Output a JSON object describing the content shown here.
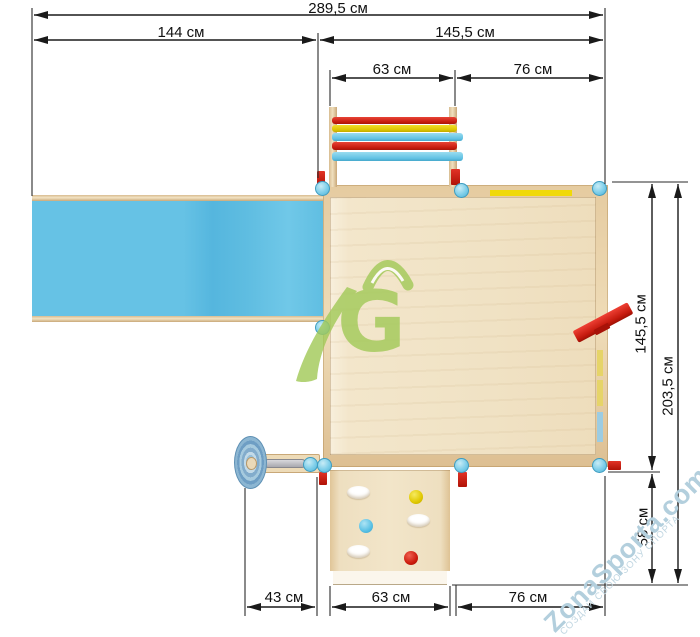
{
  "drawing": {
    "type": "playground-top-view-dimension-drawing",
    "units": "см"
  },
  "dimensions": {
    "total_width": "289,5 см",
    "slide_width": "144 см",
    "platform_width": "145,5 см",
    "ladder_width_top": "63 см",
    "top_right_width": "76 см",
    "platform_depth": "145,5 см",
    "total_depth": "203,5 см",
    "climb_wall_depth": "58 см",
    "wheel_width": "43 см",
    "climb_wall_width": "63 см",
    "bottom_right_width": "76 см"
  },
  "components": {
    "slide": {
      "name": "slide",
      "color": "#63c1e5"
    },
    "platform": {
      "name": "platform",
      "color": "#f2e5c9"
    },
    "ladder": {
      "name": "ladder",
      "rung_colors": [
        "red",
        "yellow",
        "blue",
        "red",
        "blue"
      ]
    },
    "climbing_wall": {
      "name": "climbing-wall",
      "holes": 3,
      "hold_colors": [
        "yellow",
        "blue",
        "red"
      ]
    },
    "steering_wheel": {
      "name": "steering-wheel",
      "color": "#8db8d6"
    },
    "corner_posts": {
      "count": 8,
      "color": "#7dcee9"
    },
    "handle": {
      "name": "red-handle",
      "color": "#d3281c"
    }
  },
  "watermark": {
    "brand": "ZonaSporta.com",
    "tagline": "СОЗДАЙ СВОЮ ЗОНУ СПОРТА",
    "logo_letter": "G",
    "logo_color": "#a3ca5a",
    "text_color": "#b3cfdd"
  }
}
